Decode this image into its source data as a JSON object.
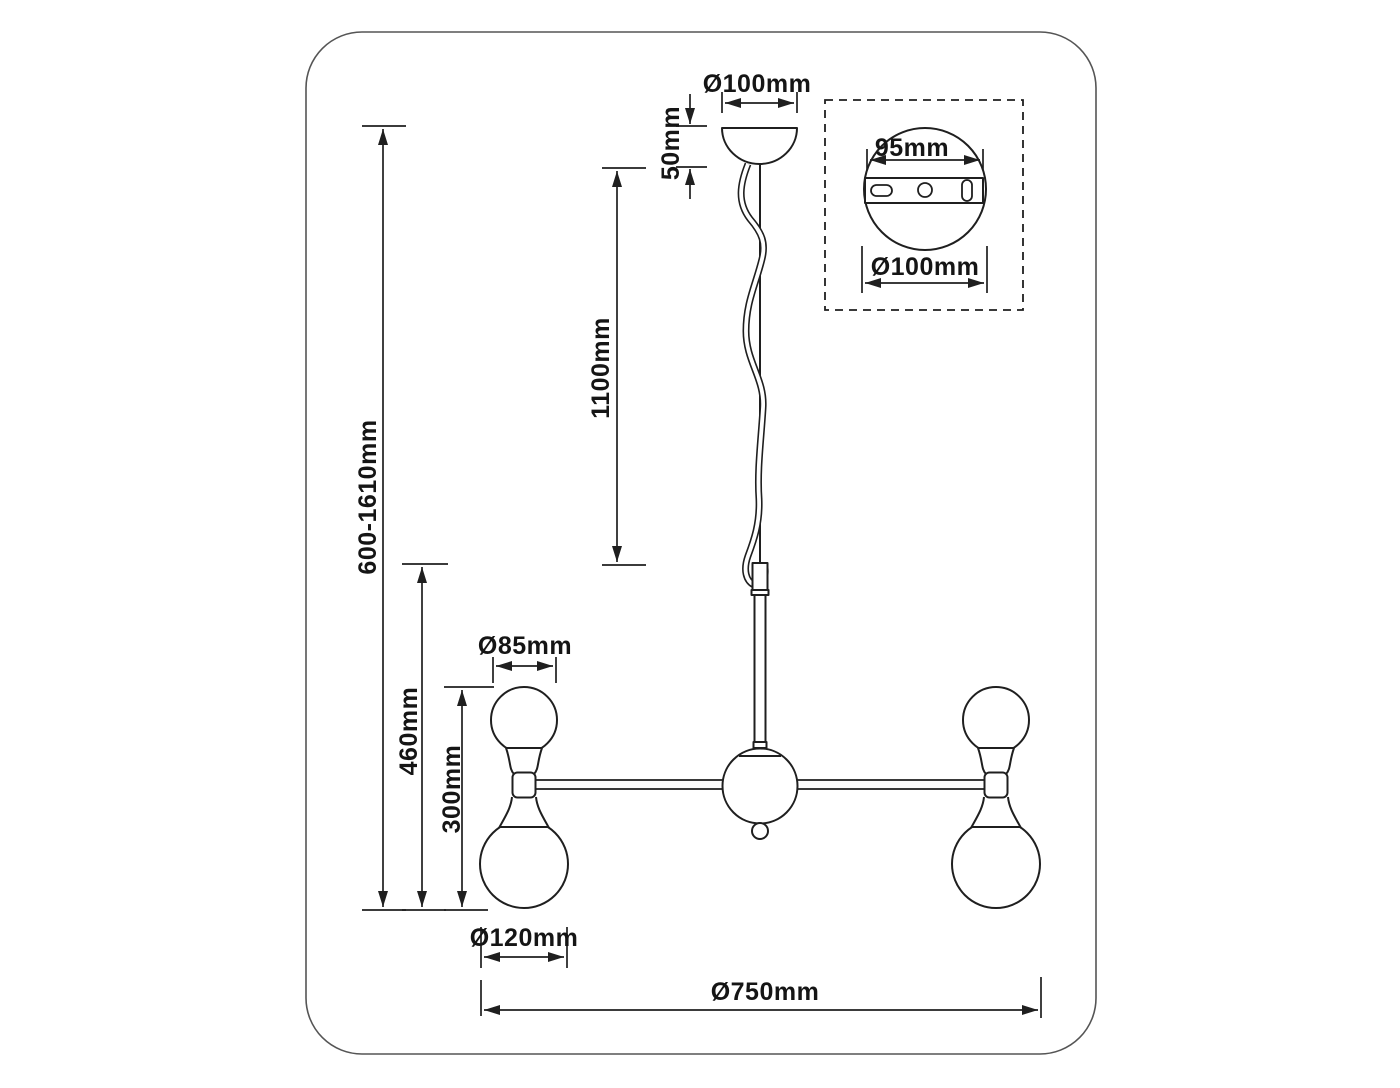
{
  "title": "Pendant chandelier dimensional drawing",
  "colors": {
    "background": "#ffffff",
    "line": "#1f1f1f",
    "frame": "#555555",
    "text": "#151515"
  },
  "labels": {
    "canopy_diameter": "Ø100mm",
    "canopy_height": "50mm",
    "cord_length": "1100mm",
    "overall_height": "600-1610mm",
    "body_height": "460mm",
    "fixture_height": "300mm",
    "small_globe_diameter": "Ø85mm",
    "large_globe_diameter": "Ø120mm",
    "overall_diameter": "Ø750mm",
    "inset_bracket_width": "95mm",
    "inset_plate_diameter": "Ø100mm"
  }
}
